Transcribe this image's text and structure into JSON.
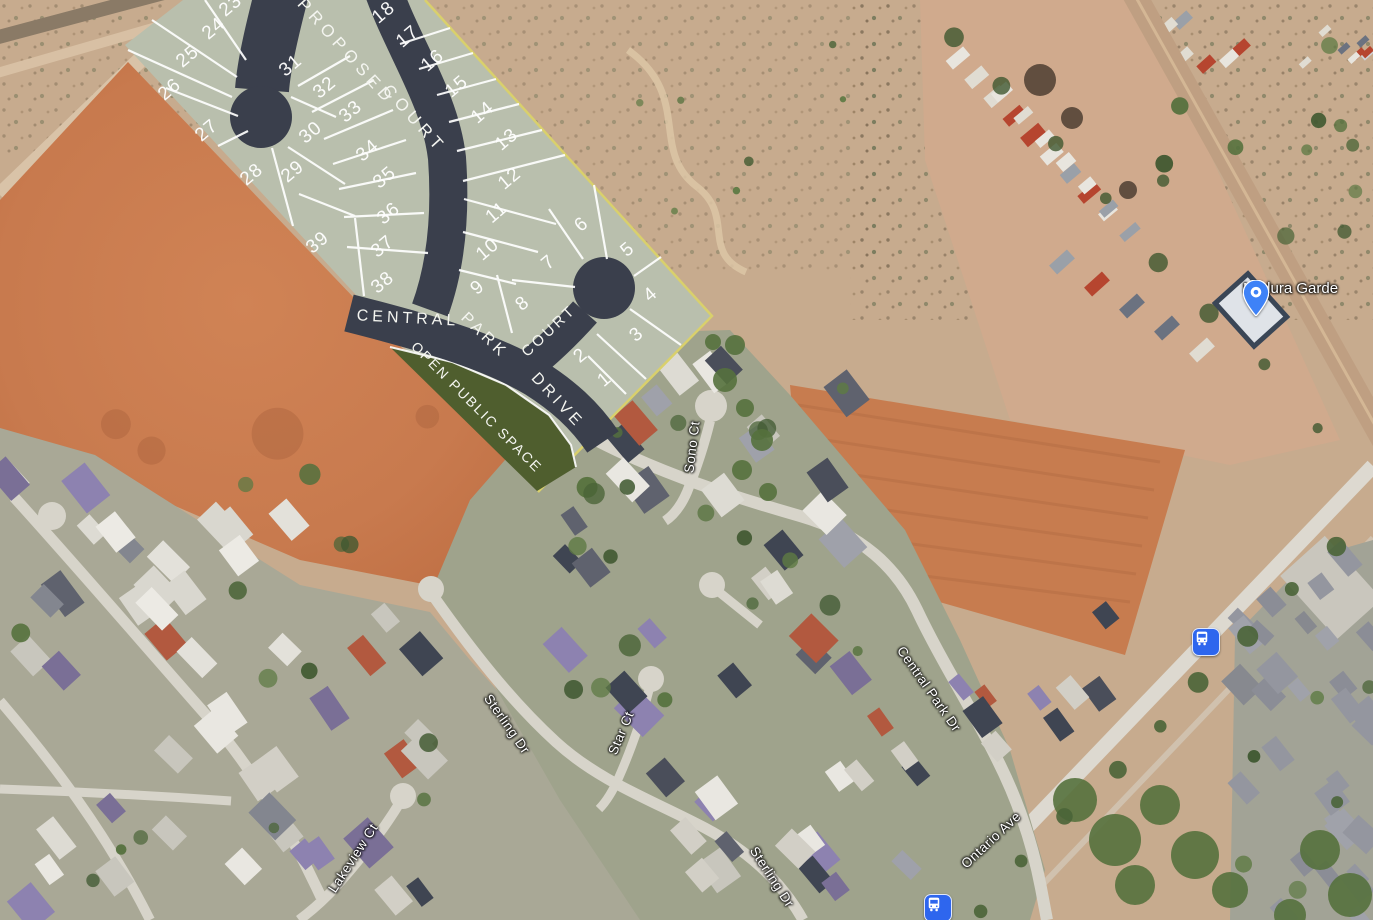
{
  "plan": {
    "name": "proposed-subdivision-overlay",
    "lot_rotation": -40,
    "lots": [
      {
        "n": "1",
        "x": 605,
        "y": 380
      },
      {
        "n": "2",
        "x": 581,
        "y": 356
      },
      {
        "n": "3",
        "x": 637,
        "y": 335
      },
      {
        "n": "4",
        "x": 651,
        "y": 295
      },
      {
        "n": "5",
        "x": 628,
        "y": 250
      },
      {
        "n": "6",
        "x": 582,
        "y": 225
      },
      {
        "n": "7",
        "x": 549,
        "y": 263
      },
      {
        "n": "8",
        "x": 523,
        "y": 304
      },
      {
        "n": "9",
        "x": 478,
        "y": 288
      },
      {
        "n": "10",
        "x": 488,
        "y": 250
      },
      {
        "n": "11",
        "x": 497,
        "y": 213
      },
      {
        "n": "12",
        "x": 510,
        "y": 179
      },
      {
        "n": "13",
        "x": 507,
        "y": 140
      },
      {
        "n": "14",
        "x": 483,
        "y": 113
      },
      {
        "n": "15",
        "x": 457,
        "y": 87
      },
      {
        "n": "16",
        "x": 433,
        "y": 61
      },
      {
        "n": "17",
        "x": 408,
        "y": 37
      },
      {
        "n": "18",
        "x": 384,
        "y": 13
      },
      {
        "n": "23",
        "x": 231,
        "y": 6
      },
      {
        "n": "24",
        "x": 214,
        "y": 29
      },
      {
        "n": "25",
        "x": 188,
        "y": 57
      },
      {
        "n": "26",
        "x": 170,
        "y": 90
      },
      {
        "n": "27",
        "x": 207,
        "y": 131
      },
      {
        "n": "28",
        "x": 252,
        "y": 175
      },
      {
        "n": "29",
        "x": 293,
        "y": 172
      },
      {
        "n": "30",
        "x": 311,
        "y": 133
      },
      {
        "n": "31",
        "x": 291,
        "y": 66
      },
      {
        "n": "32",
        "x": 325,
        "y": 88
      },
      {
        "n": "33",
        "x": 351,
        "y": 112
      },
      {
        "n": "34",
        "x": 368,
        "y": 151
      },
      {
        "n": "35",
        "x": 385,
        "y": 178
      },
      {
        "n": "36",
        "x": 389,
        "y": 214
      },
      {
        "n": "37",
        "x": 383,
        "y": 247
      },
      {
        "n": "38",
        "x": 383,
        "y": 283
      },
      {
        "n": "39",
        "x": 318,
        "y": 243
      }
    ],
    "road_labels": [
      {
        "text": "PROPOSED",
        "x": 346,
        "y": 52,
        "rot": 48,
        "size": 17,
        "ls": 5
      },
      {
        "text": "COURT",
        "x": 414,
        "y": 119,
        "rot": 48,
        "size": 17,
        "ls": 5
      },
      {
        "text": "CENTRAL",
        "x": 408,
        "y": 319,
        "rot": 3,
        "size": 16,
        "ls": 4
      },
      {
        "text": "PARK",
        "x": 484,
        "y": 336,
        "rot": 44,
        "size": 16,
        "ls": 4
      },
      {
        "text": "DRIVE",
        "x": 557,
        "y": 401,
        "rot": 47,
        "size": 16,
        "ls": 4
      },
      {
        "text": "COURT",
        "x": 549,
        "y": 331,
        "rot": -43,
        "size": 15,
        "ls": 3
      },
      {
        "text": "OPEN PUBLIC SPACE",
        "x": 477,
        "y": 407,
        "rot": 45,
        "size": 14,
        "ls": 2
      }
    ]
  },
  "streets": [
    {
      "text": "Sono Ct",
      "x": 692,
      "y": 447,
      "rot": -83
    },
    {
      "text": "Central Park Dr",
      "x": 929,
      "y": 689,
      "rot": 55
    },
    {
      "text": "Sterling Dr",
      "x": 507,
      "y": 724,
      "rot": 55
    },
    {
      "text": "Star Ct",
      "x": 621,
      "y": 733,
      "rot": -67
    },
    {
      "text": "Lakeview Ct",
      "x": 353,
      "y": 858,
      "rot": -57
    },
    {
      "text": "Sterling Dr",
      "x": 772,
      "y": 877,
      "rot": 57
    },
    {
      "text": "Ontario Ave",
      "x": 991,
      "y": 840,
      "rot": -43
    }
  ],
  "poi": {
    "label": "Mildura Garde",
    "x": 1243,
    "y": 298
  },
  "transit_stops": [
    {
      "x": 1205,
      "y": 641
    },
    {
      "x": 937,
      "y": 907
    }
  ],
  "colors": {
    "plan_fill": "#b9bfad",
    "plan_road": "#3a3f4c",
    "open_space": "#4f5e2e",
    "plan_boundary": "#d9d06c",
    "lot_line": "#ffffff",
    "orange_field": "#c87a4e",
    "scrub": "#c8ad90",
    "sat_road": "#d7d4ca",
    "tree": "#4a6437",
    "pin_blue": "#3e82f7",
    "bus_blue": "#2e66ee"
  }
}
